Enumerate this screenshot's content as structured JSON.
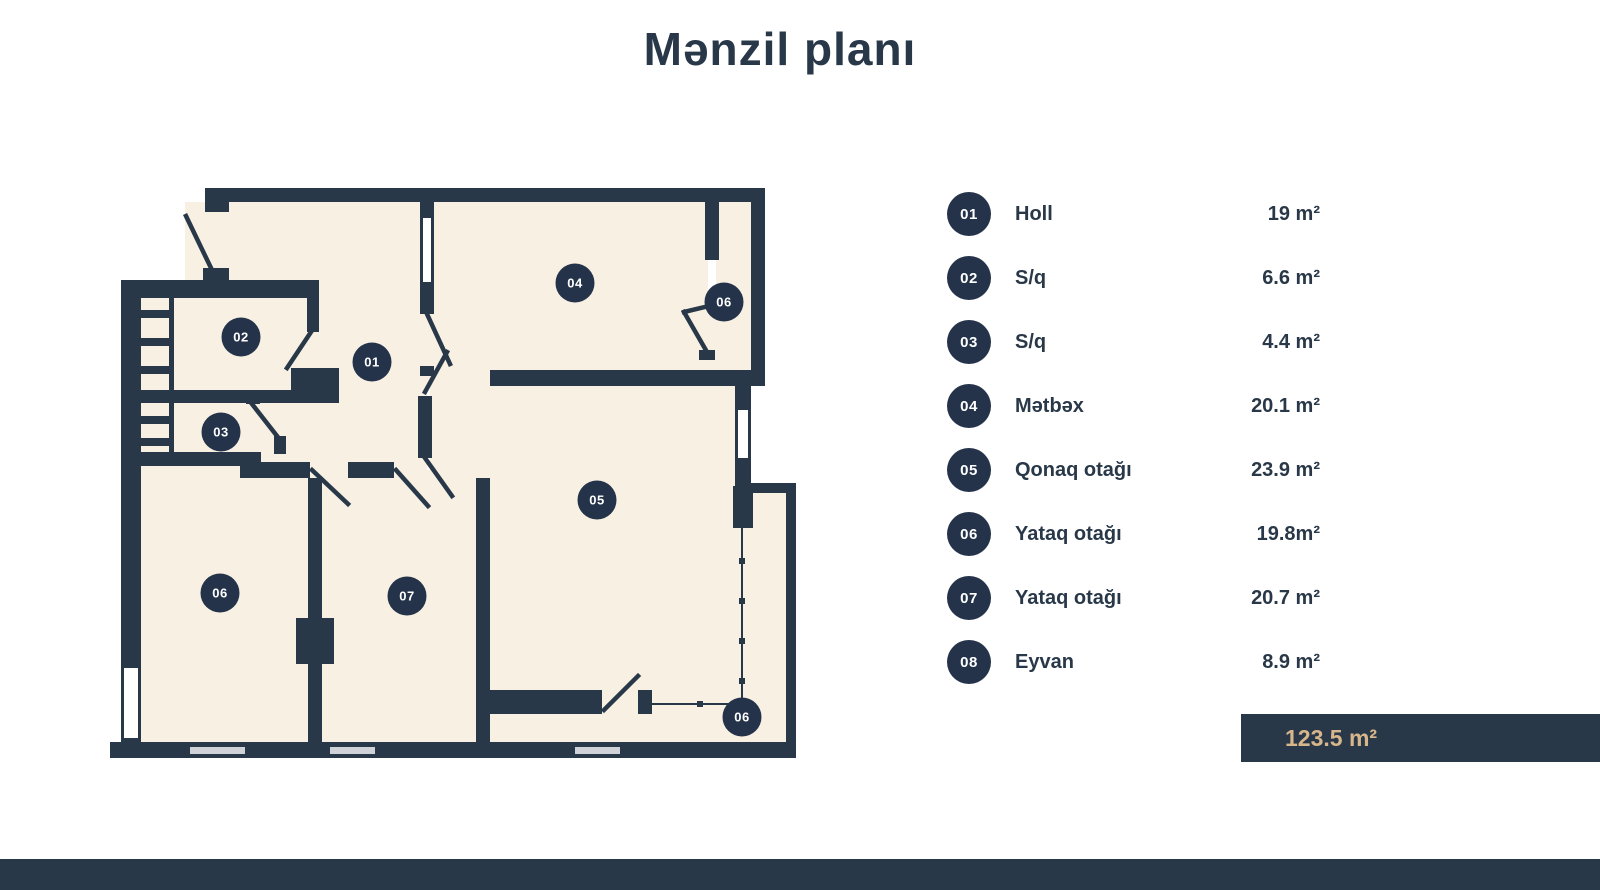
{
  "title": "Mənzil planı",
  "colors": {
    "wall": "#293848",
    "floor": "#f7f0e3",
    "accent": "#d7b68c",
    "badge": "#243349"
  },
  "legend": {
    "rooms": [
      {
        "num": "01",
        "label": "Holl",
        "area": "19 m²"
      },
      {
        "num": "02",
        "label": "S/q",
        "area": "6.6 m²"
      },
      {
        "num": "03",
        "label": "S/q",
        "area": "4.4 m²"
      },
      {
        "num": "04",
        "label": "Mətbəx",
        "area": "20.1 m²"
      },
      {
        "num": "05",
        "label": "Qonaq otağı",
        "area": "23.9 m²"
      },
      {
        "num": "06",
        "label": "Yataq otağı",
        "area": "19.8m²"
      },
      {
        "num": "07",
        "label": "Yataq otağı",
        "area": "20.7 m²"
      },
      {
        "num": "08",
        "label": "Eyvan",
        "area": "8.9 m²"
      }
    ],
    "total": "123.5 m²"
  },
  "plan": {
    "markers": [
      {
        "label": "01",
        "x": 372,
        "y": 362
      },
      {
        "label": "02",
        "x": 241,
        "y": 337
      },
      {
        "label": "03",
        "x": 221,
        "y": 432
      },
      {
        "label": "04",
        "x": 575,
        "y": 283
      },
      {
        "label": "06",
        "x": 724,
        "y": 302
      },
      {
        "label": "05",
        "x": 597,
        "y": 500
      },
      {
        "label": "06",
        "x": 220,
        "y": 593
      },
      {
        "label": "07",
        "x": 407,
        "y": 596
      },
      {
        "label": "06",
        "x": 742,
        "y": 717
      }
    ]
  }
}
